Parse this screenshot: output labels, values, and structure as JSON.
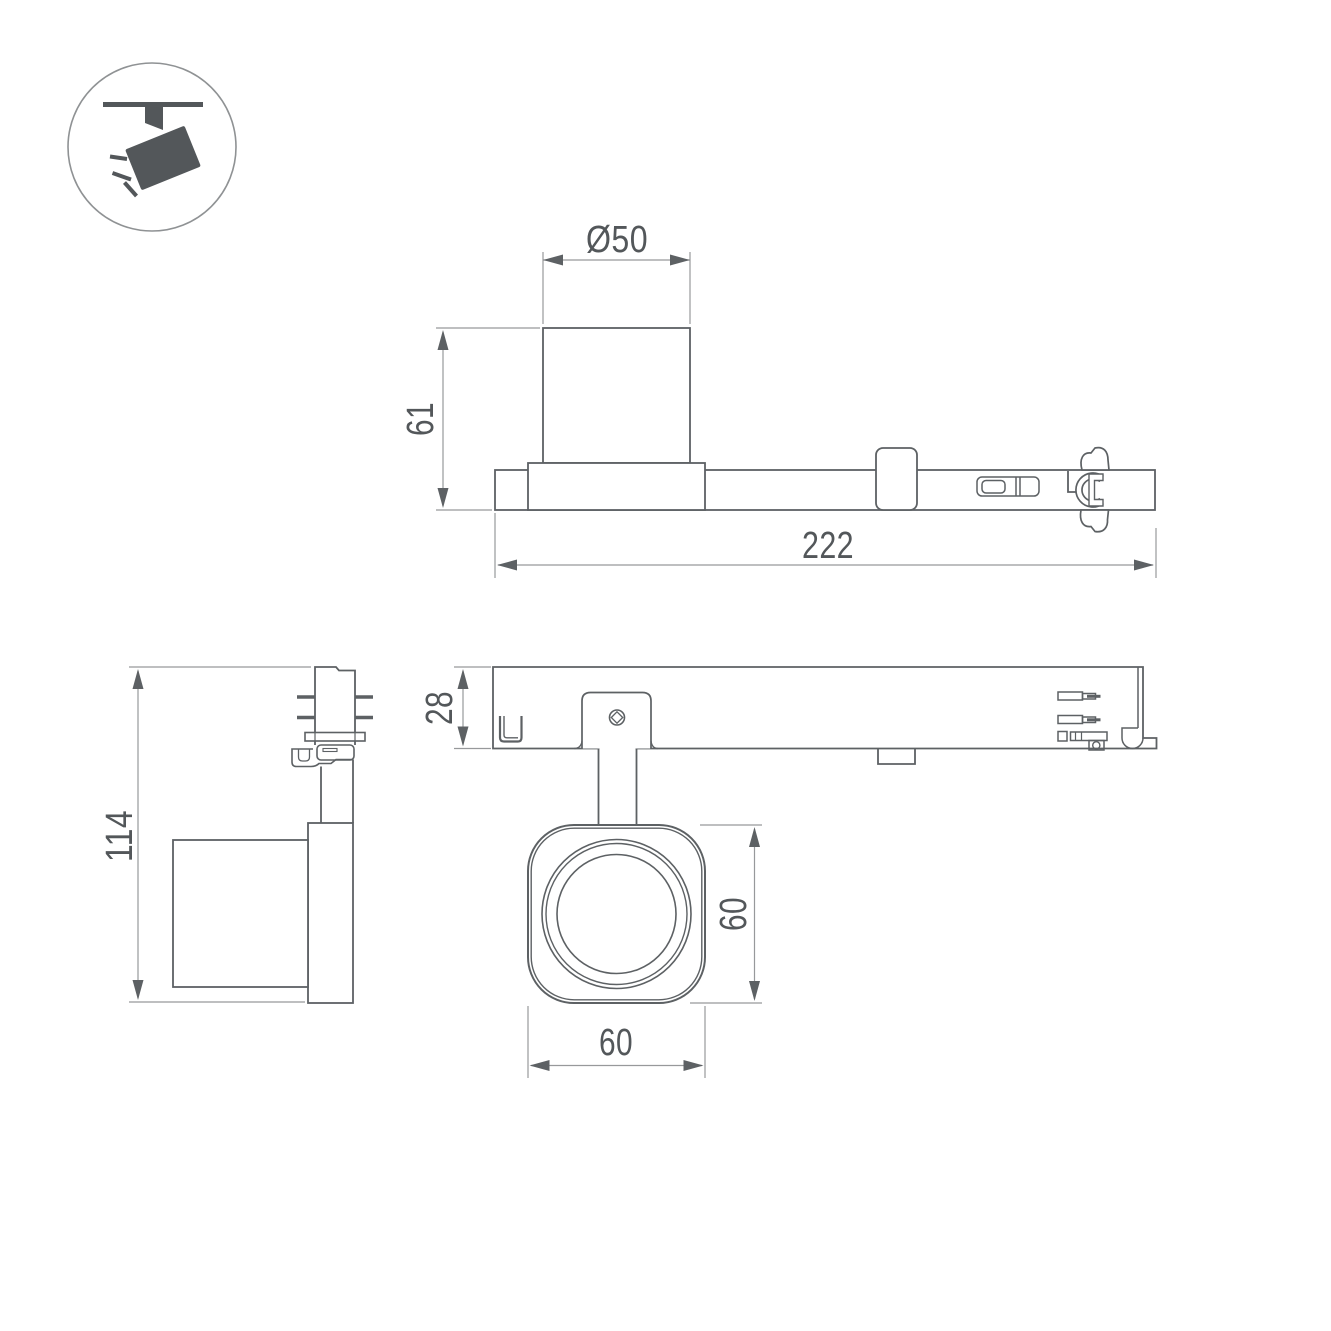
{
  "drawing": {
    "title": "track-spotlight-dimension-drawing",
    "icon": {
      "type": "track-spotlight-pictogram"
    },
    "views": {
      "side": {
        "labels": {
          "diameter": "Ø50",
          "height": "61",
          "length": "222"
        }
      },
      "front": {
        "labels": {
          "overall_height": "114"
        }
      },
      "plan": {
        "labels": {
          "rail_depth": "28",
          "head_height": "60",
          "head_width": "60"
        }
      }
    },
    "colors": {
      "outline": "#5d6164",
      "dimension_line": "#97999b",
      "dimension_text": "#53575a",
      "icon_fill": "#53575a",
      "icon_circle_stroke": "#8f9294",
      "background": "#ffffff"
    }
  }
}
